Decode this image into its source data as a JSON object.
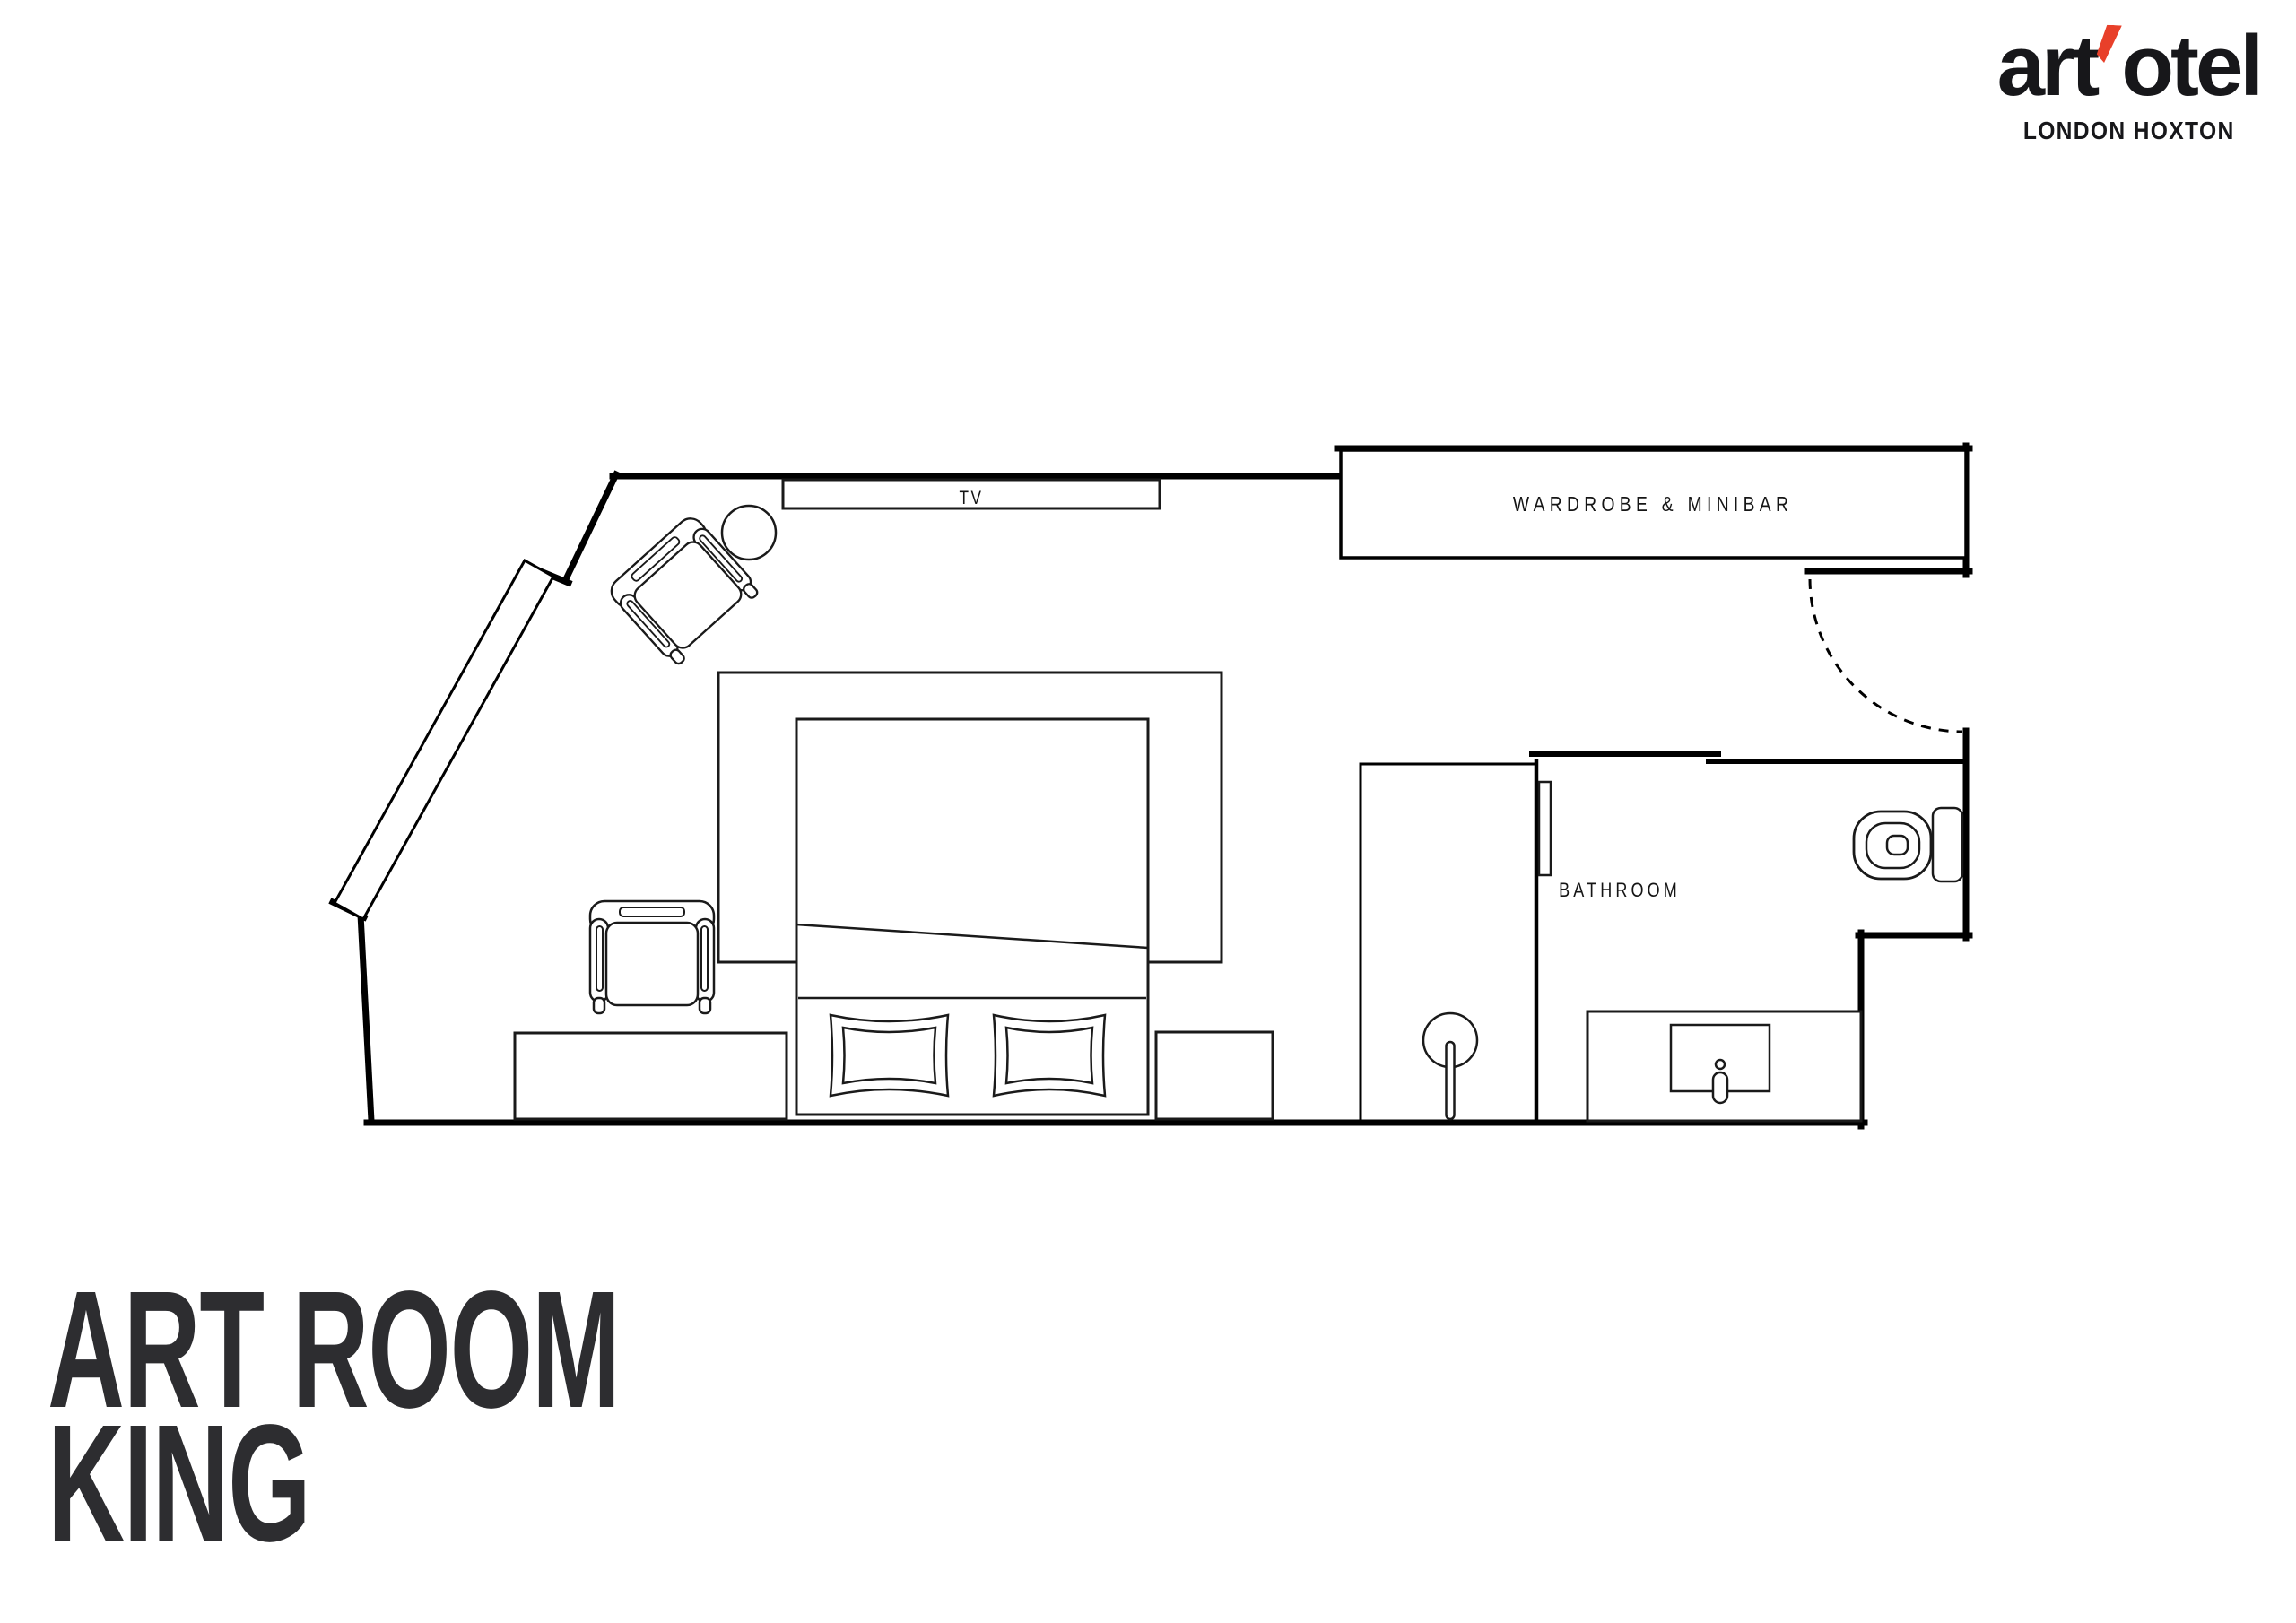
{
  "page": {
    "background": "#ffffff",
    "line_color": "#000000"
  },
  "logo": {
    "word_start": "art",
    "word_end": "otel",
    "apostrophe_color": "#E8402A",
    "subtitle": "LONDON HOXTON",
    "text_color": "#17171a"
  },
  "title": {
    "line1": "ART ROOM",
    "line2": "KING",
    "color": "#2D2D30"
  },
  "plan": {
    "labels": {
      "tv": "TV",
      "wardrobe": "WARDROBE & MINIBAR",
      "bathroom": "BATHROOM"
    }
  }
}
